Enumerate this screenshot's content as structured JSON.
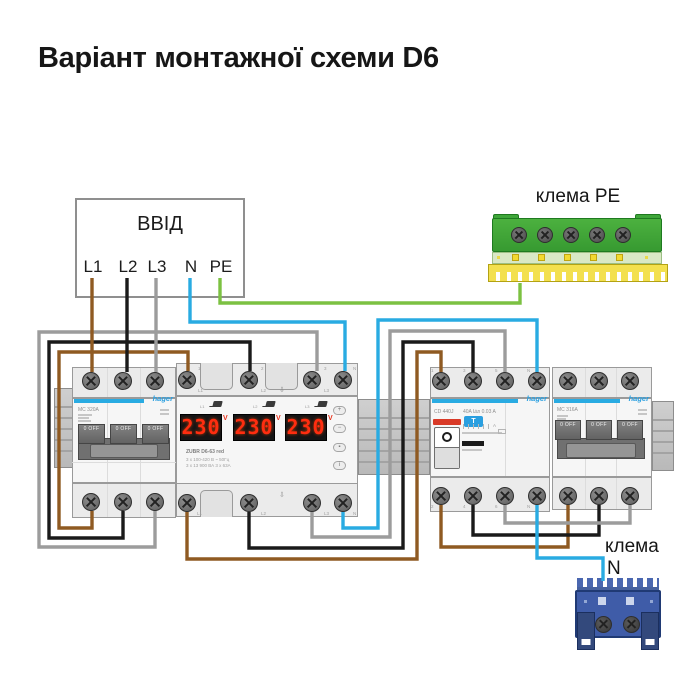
{
  "title": "Варіант монтажної схеми D6",
  "input_box": {
    "title": "ВВІД",
    "terminals": [
      "L1",
      "L2",
      "L3",
      "N",
      "PE"
    ]
  },
  "pe_terminal": {
    "label": "клема PE"
  },
  "n_terminal": {
    "label_line1": "клема",
    "label_line2": "N"
  },
  "breaker_left": {
    "brand": "hager",
    "model": "MC 320A",
    "toggle_label": "0 OFF"
  },
  "voltage_relay": {
    "model": "ZUBR D6-63 red",
    "spec_line1": "3 x 100-420 В ~ 50Гц",
    "spec_line2": "3 x 13 900 ВА   3 x 63А",
    "displays": [
      {
        "phase": "L1",
        "value": "230",
        "unit": "V"
      },
      {
        "phase": "L2",
        "value": "230",
        "unit": "V"
      },
      {
        "phase": "L3",
        "value": "230",
        "unit": "V"
      }
    ],
    "top_terminals": [
      "1",
      "2",
      "3",
      "N"
    ],
    "top_terminal_sub": [
      "L1",
      "L2",
      "L3",
      ""
    ],
    "bottom_terminal_sub": [
      "L1",
      "L2",
      "L3",
      "N"
    ],
    "buttons": [
      "+",
      "−",
      "▪",
      "i"
    ],
    "arrow": "⇩"
  },
  "rcd": {
    "brand": "hager",
    "model": "CD 440J",
    "rating": "40A I∆n 0.03 A",
    "test_button": "T",
    "top_terminals": [
      "1",
      "3",
      "5",
      "N"
    ],
    "bottom_terminals": [
      "2",
      "4",
      "6",
      "N"
    ]
  },
  "breaker_right": {
    "brand": "hager",
    "model": "MC 316A",
    "toggle_label": "0 OFF"
  },
  "wire_colors": {
    "L1": "#8f5a22",
    "L2": "#1a1a1a",
    "L3": "#9c9c9c",
    "N": "#29abe2",
    "PE": "#7cc142"
  }
}
